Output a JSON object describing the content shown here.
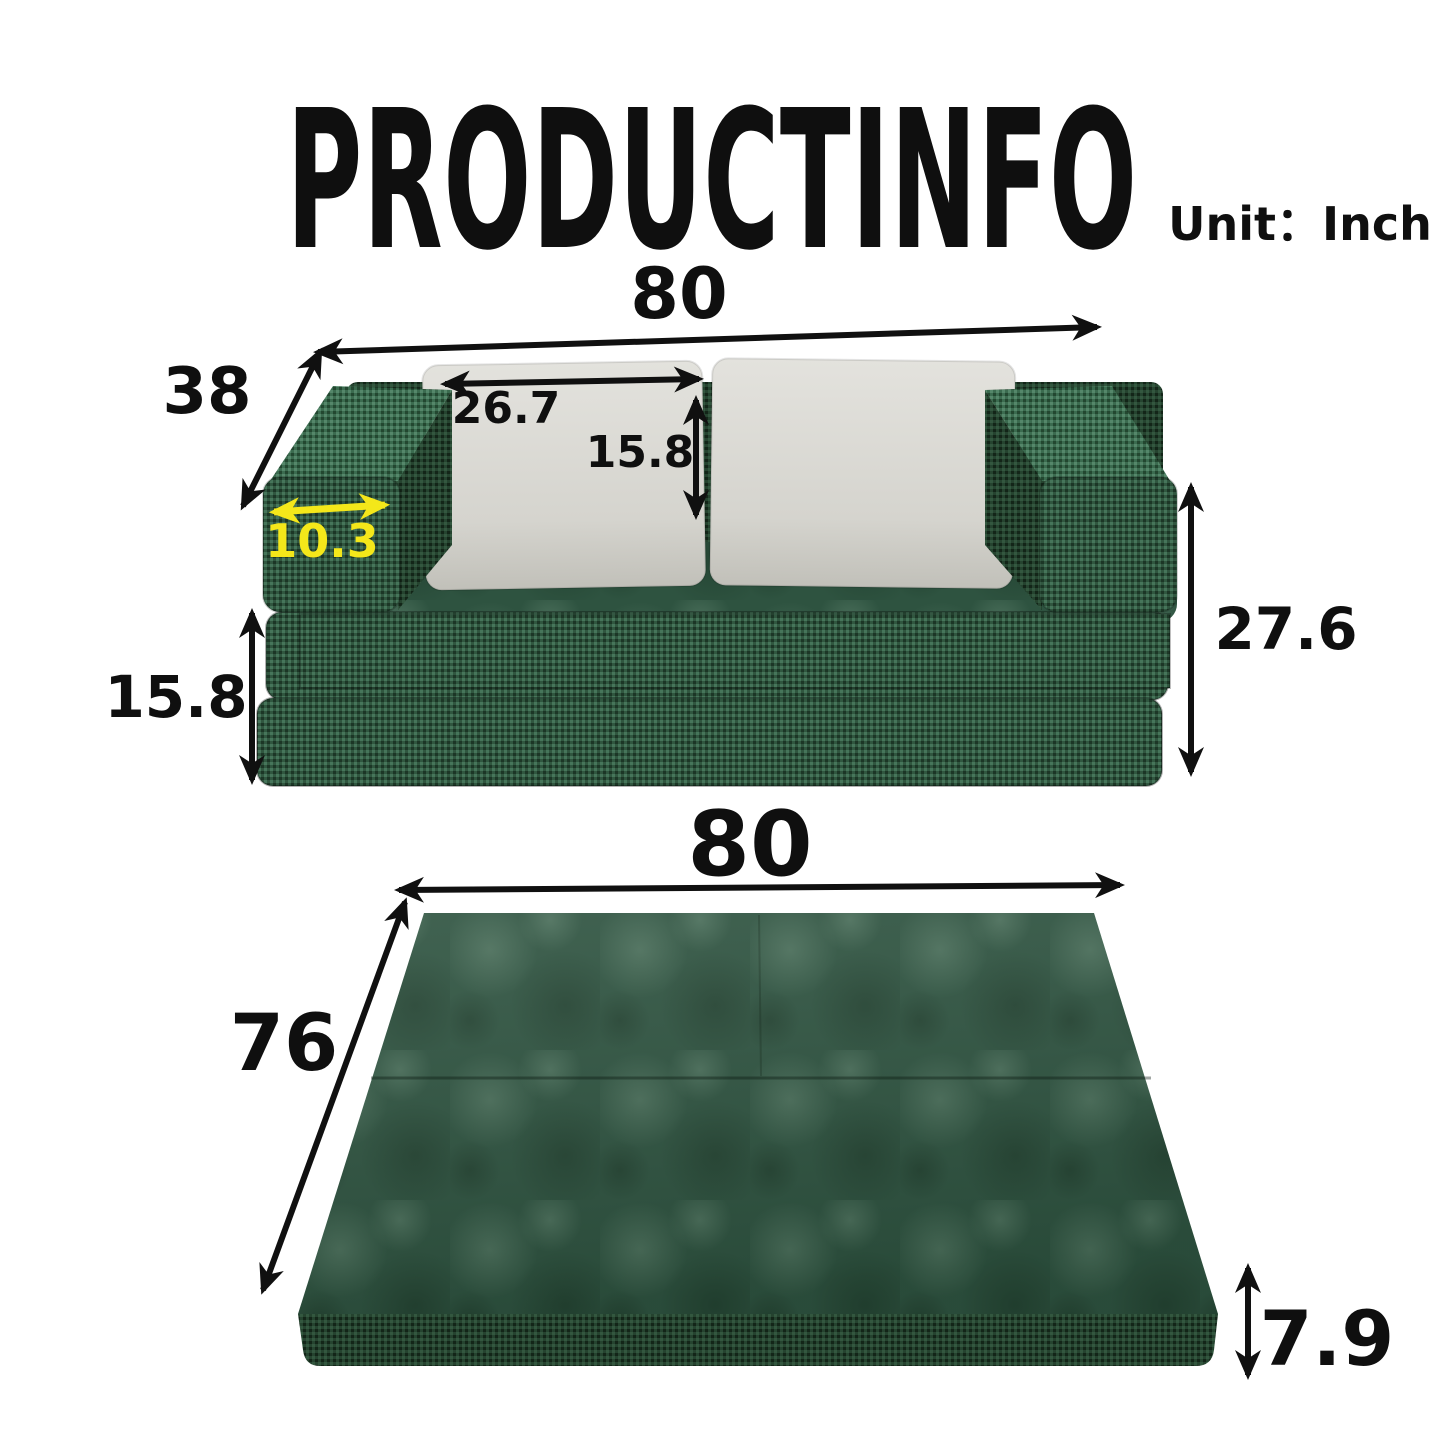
{
  "header": {
    "title": "PRODUCTINFO",
    "unit_label": "Unit：Inch"
  },
  "sofa_view": {
    "width": "80",
    "depth": "38",
    "pillow_width": "26.7",
    "pillow_height": "15.8",
    "armrest_width": "10.3",
    "base_height": "15.8",
    "total_height": "27.6"
  },
  "bed_view": {
    "width": "80",
    "depth": "76",
    "thickness": "7.9"
  },
  "colors": {
    "sofa_green": "#2F5441",
    "pillow_gray": "#D8D7D2",
    "accent_yellow": "#F4E71A",
    "dimension_black": "#101010"
  }
}
